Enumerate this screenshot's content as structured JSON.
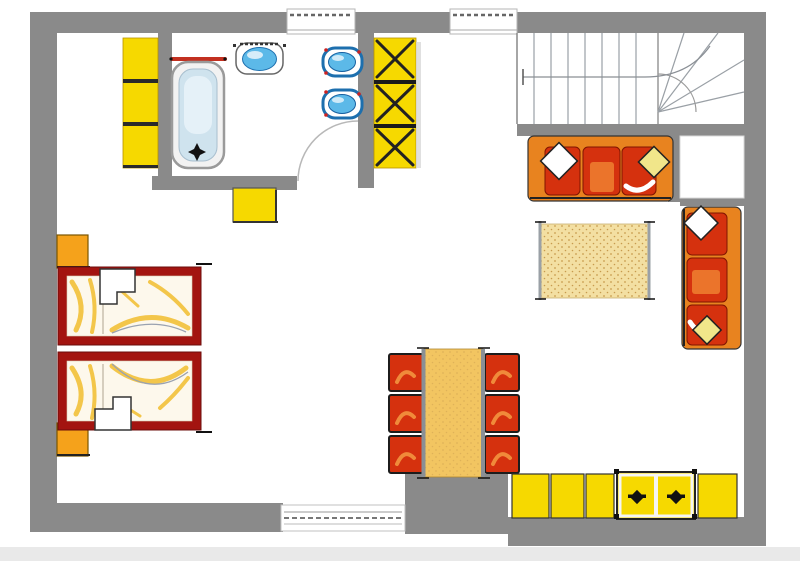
{
  "title": "Apartment floor plan (no visible text in drawing)",
  "colors": {
    "wall": "#8a8a8a",
    "yellow": "#f6d900",
    "orange": "#f5a21b",
    "sofa_orange": "#e8831f",
    "red": "#d5310e",
    "bed_frame": "#a31410",
    "table_wood": "#f2c561",
    "rug": "#f3dfa2",
    "fixture_blue": "#5cb9e8",
    "fixture_blue_dark": "#1d6fae",
    "tub_inner": "#cfe3ee",
    "bedding": "#fdf8ec",
    "streak_yellow": "#f3c64a",
    "line_dark": "#222222",
    "line_gray": "#9a9a9a",
    "shadow": "#e9e9e9"
  },
  "items": [
    {
      "id": "bathtub"
    },
    {
      "id": "toilet"
    },
    {
      "id": "wash-basin",
      "count": 2
    },
    {
      "id": "wardrobe-shelf-left"
    },
    {
      "id": "wardrobe-hall-x-pattern"
    },
    {
      "id": "dresser-stool-yellow"
    },
    {
      "id": "staircase-with-winder"
    },
    {
      "id": "sofa-horizontal-3-seat"
    },
    {
      "id": "sofa-vertical-3-seat"
    },
    {
      "id": "rug"
    },
    {
      "id": "twin-bed",
      "count": 2
    },
    {
      "id": "nightstand",
      "count": 2
    },
    {
      "id": "dining-table"
    },
    {
      "id": "dining-chair",
      "count": 6
    },
    {
      "id": "kitchen-cabinet",
      "count": 4
    },
    {
      "id": "stove-unit"
    },
    {
      "id": "window",
      "count": 3
    },
    {
      "id": "door-swing",
      "count": 1
    }
  ]
}
